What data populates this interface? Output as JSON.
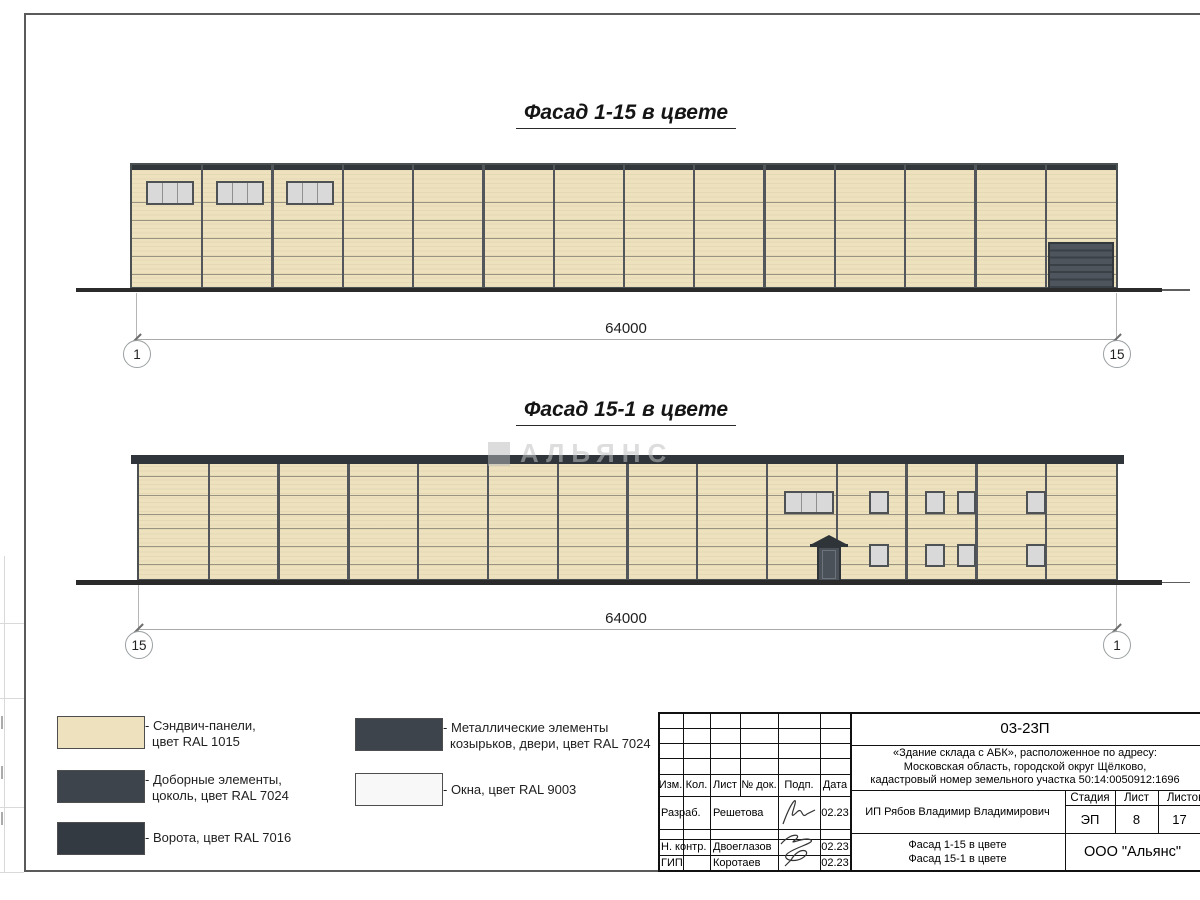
{
  "titles": {
    "facade1": "Фасад 1-15 в цвете",
    "facade2": "Фасад 15-1 в цвете"
  },
  "watermark": "АЛЬЯНС",
  "facade1": {
    "dim": "64000",
    "axis_left": "1",
    "axis_right": "15"
  },
  "facade2": {
    "dim": "64000",
    "axis_left": "15",
    "axis_right": "1"
  },
  "legend": {
    "items": [
      {
        "color": "#EDE1BE",
        "line1": "- Сэндвич-панели,",
        "line2": "цвет RAL 1015"
      },
      {
        "color": "#3E444B",
        "line1": "- Доборные элементы,",
        "line2": "цоколь, цвет RAL 7024"
      },
      {
        "color": "#343A42",
        "line1": "- Ворота, цвет RAL 7016",
        "line2": ""
      },
      {
        "color": "#3E444B",
        "line1": "- Металлические элементы",
        "line2": "козырьков, двери, цвет RAL 7024"
      },
      {
        "color": "#F8F8F8",
        "line1": "- Окна, цвет RAL 9003",
        "line2": ""
      }
    ]
  },
  "titleblock": {
    "code": "03-23П",
    "object_line1": "«Здание склада с АБК», расположенное по адресу:",
    "object_line2": "Московская область, городской округ Щёлково,",
    "object_line3": "кадастровый номер земельного участка 50:14:0050912:1696",
    "columns": [
      "Изм.",
      "Кол.",
      "Лист",
      "№ док.",
      "Подп.",
      "Дата"
    ],
    "rows": [
      {
        "role": "Разраб.",
        "name": "Решетова",
        "date": "02.23"
      },
      {
        "role": "Н. контр.",
        "name": "Двоеглазов",
        "date": "02.23"
      },
      {
        "role": "ГИП",
        "name": "Коротаев",
        "date": "02.23"
      }
    ],
    "client": "ИП Рябов Владимир Владимирович",
    "stage_label": "Стадия",
    "sheet_label": "Лист",
    "sheets_label": "Листов",
    "stage": "ЭП",
    "sheet": "8",
    "sheets": "17",
    "sheet_title_line1": "Фасад 1-15 в цвете",
    "sheet_title_line2": "Фасад 15-1 в цвете",
    "company": "ООО \"Альянс\""
  },
  "drawing": {
    "facade1": {
      "bays": 14,
      "joints": [
        37,
        55,
        73,
        91,
        109
      ],
      "windows": [
        {
          "x": 14,
          "y": 16,
          "w": 48,
          "h": 24,
          "panes": 3
        },
        {
          "x": 84,
          "y": 16,
          "w": 48,
          "h": 24,
          "panes": 3
        },
        {
          "x": 154,
          "y": 16,
          "w": 48,
          "h": 24,
          "panes": 3
        }
      ],
      "gate": {
        "x": 916,
        "y": 77,
        "w": 66,
        "h": 49
      }
    },
    "facade2": {
      "bays": 14,
      "joints": [
        19,
        38,
        57,
        71,
        89,
        107
      ],
      "windows": [
        {
          "x": 645,
          "y": 34,
          "w": 50,
          "h": 23,
          "panes": 3
        },
        {
          "x": 730,
          "y": 34,
          "w": 20,
          "h": 23,
          "panes": 1
        },
        {
          "x": 786,
          "y": 34,
          "w": 20,
          "h": 23,
          "panes": 1
        },
        {
          "x": 818,
          "y": 34,
          "w": 19,
          "h": 23,
          "panes": 1
        },
        {
          "x": 887,
          "y": 34,
          "w": 20,
          "h": 23,
          "panes": 1
        },
        {
          "x": 730,
          "y": 87,
          "w": 20,
          "h": 23,
          "panes": 1
        },
        {
          "x": 786,
          "y": 87,
          "w": 20,
          "h": 23,
          "panes": 1
        },
        {
          "x": 818,
          "y": 87,
          "w": 19,
          "h": 23,
          "panes": 1
        },
        {
          "x": 887,
          "y": 87,
          "w": 20,
          "h": 23,
          "panes": 1
        }
      ],
      "door": {
        "x": 678,
        "y": 89,
        "w": 24,
        "h": 37
      }
    }
  }
}
